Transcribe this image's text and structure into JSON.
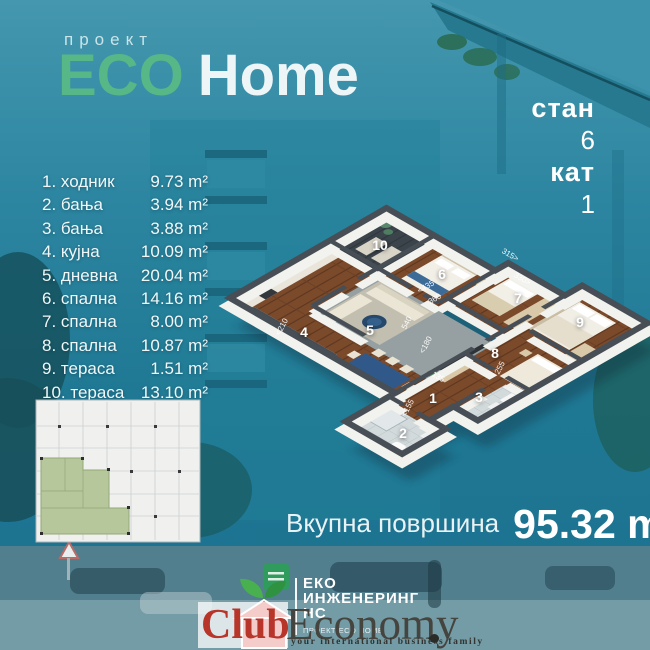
{
  "header": {
    "project_label": "проект",
    "title_eco": "ECO",
    "title_home": "Home"
  },
  "unit": {
    "stan_label": "стан",
    "stan_value": "6",
    "kat_label": "кат",
    "kat_value": "1"
  },
  "rooms": [
    {
      "num": "1.",
      "name": "ходник",
      "area": "9.73 m²"
    },
    {
      "num": "2.",
      "name": "бања",
      "area": "3.94 m²"
    },
    {
      "num": "3.",
      "name": "бања",
      "area": "3.88 m²"
    },
    {
      "num": "4.",
      "name": "кујна",
      "area": "10.09 m²"
    },
    {
      "num": "5.",
      "name": "дневна",
      "area": "20.04 m²"
    },
    {
      "num": "6.",
      "name": "спална",
      "area": "14.16 m²"
    },
    {
      "num": "7.",
      "name": "спална",
      "area": "8.00 m²"
    },
    {
      "num": "8.",
      "name": "спална",
      "area": "10.87 m²"
    },
    {
      "num": "9.",
      "name": "тераса",
      "area": "1.51 m²"
    },
    {
      "num": "10.",
      "name": "тераса",
      "area": "13.10 m²"
    }
  ],
  "total": {
    "label": "Вкупна површина",
    "value": "95.32 m",
    "sup": "2"
  },
  "plan": {
    "numbers": [
      "1",
      "2",
      "3",
      "4",
      "5",
      "6",
      "7",
      "8",
      "9",
      "10"
    ],
    "dims": [
      "<435",
      "360",
      "315>",
      "330>",
      "540",
      "<180",
      "255",
      "135",
      "<155",
      "<210"
    ]
  },
  "logo": {
    "line1": "ЕКО",
    "line2": "ИНЖЕНЕРИНГ",
    "line3": "НС",
    "tagline": "ПРОЕКТ ECO HOME"
  },
  "watermark": {
    "club": "Club",
    "economy": "Economy",
    "tagline": "your  international  business  family"
  },
  "colors": {
    "accent_green": "#57b787",
    "background_teal": "#247c97",
    "watermark_red": "#b8352a",
    "plan_green": "#b7c79c"
  }
}
